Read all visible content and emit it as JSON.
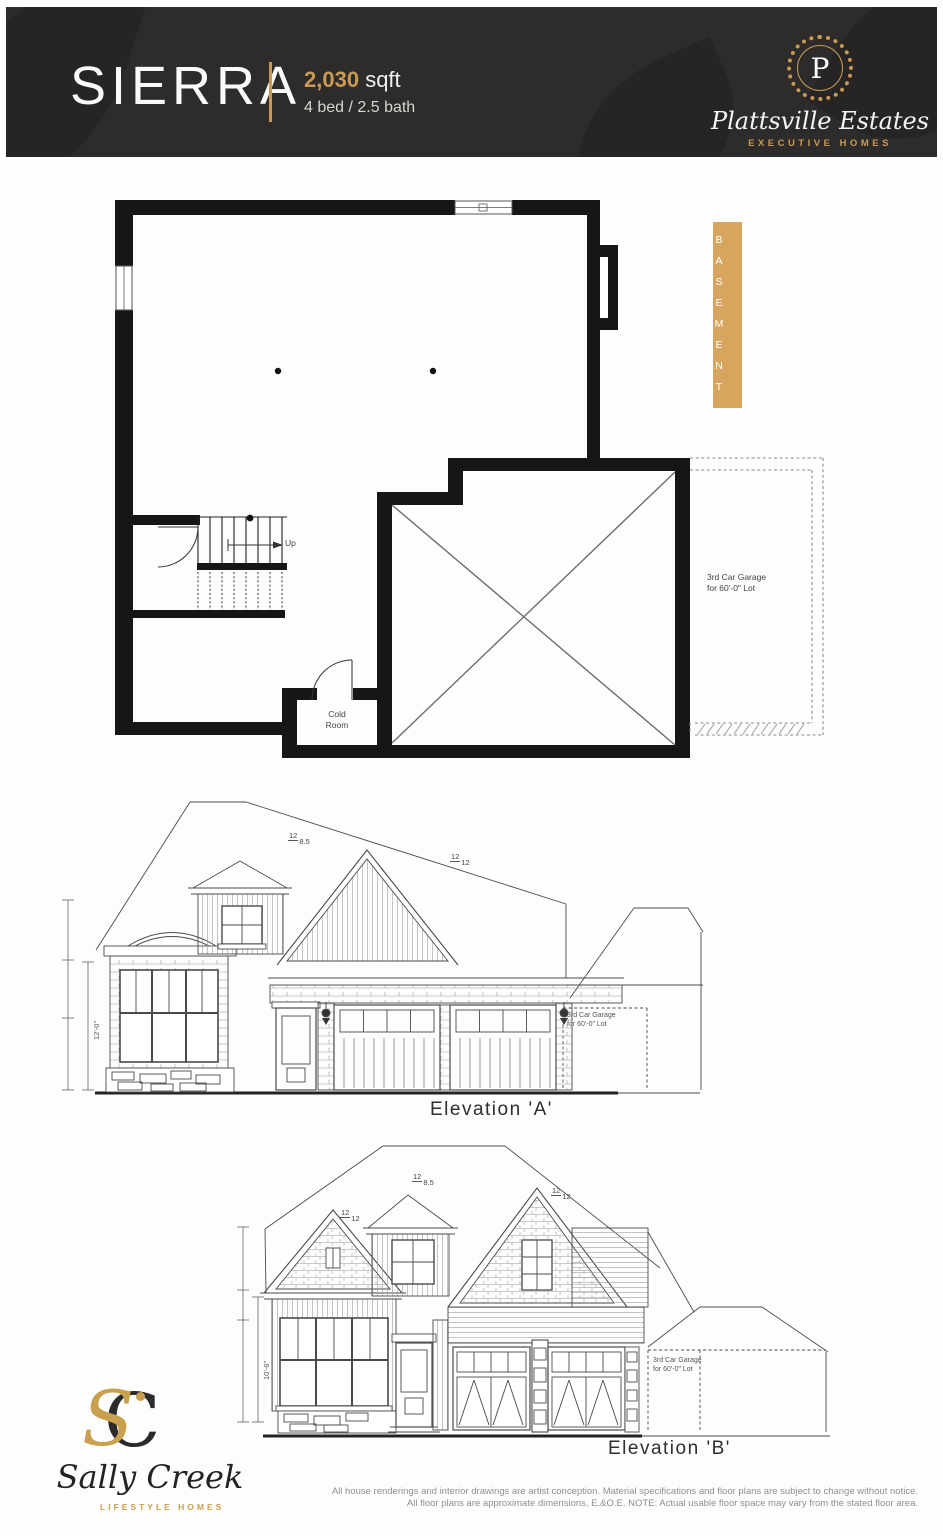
{
  "header": {
    "model": "SIERRA",
    "sqft_value": "2,030",
    "sqft_unit": "sqft",
    "specs": "4 bed / 2.5 bath",
    "brand": {
      "monogram": "P",
      "name": "Plattsville Estates",
      "tagline": "EXECUTIVE HOMES"
    }
  },
  "colors": {
    "header_bg": "#2d2c2a",
    "accent_gold": "#c89a55",
    "basement_tab": "#d8a55f",
    "line_ink": "#4a4a4a"
  },
  "plan": {
    "label": "BASEMENT",
    "up": "Up",
    "cold_room_line1": "Cold",
    "cold_room_line2": "Room",
    "garage_note_line1": "3rd Car Garage",
    "garage_note_line2": "for 60'-0\" Lot"
  },
  "elevations": {
    "a": {
      "caption": "Elevation 'A'",
      "garage_note_line1": "3rd Car Garage",
      "garage_note_line2": "for 60'-0\" Lot",
      "dim": "12'-0\"",
      "pitch_main": "12",
      "pitch_main_val": "8.5",
      "pitch_gable": "12",
      "pitch_gable_val": "12"
    },
    "b": {
      "caption": "Elevation 'B'",
      "garage_note_line1": "3rd Car Garage",
      "garage_note_line2": "for 60'-0\" Lot",
      "dim": "10'-6\"",
      "pitch_left": "12",
      "pitch_left_val": "12",
      "pitch_dormer": "12",
      "pitch_dormer_val": "8.5",
      "pitch_right": "12",
      "pitch_right_val": "12"
    }
  },
  "footer": {
    "builder": {
      "monogram_s": "S",
      "monogram_c": "C",
      "name": "Sally Creek",
      "tagline": "LIFESTYLE HOMES"
    },
    "disclaimer_line1": "All house renderings and interior drawings are artist conception. Material specifications and floor plans are subject to change without notice.",
    "disclaimer_line2": "All floor plans are approximate dimensions, E.&O.E. NOTE: Actual usable floor space may vary from the stated floor area."
  }
}
